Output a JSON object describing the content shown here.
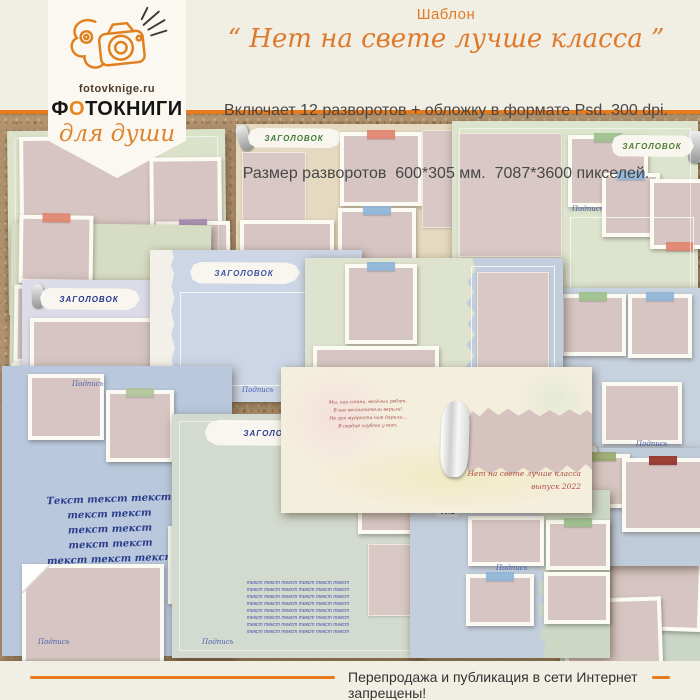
{
  "header": {
    "title": "Шаблон",
    "quote": "“ Нет на свете лучше класса ”",
    "desc1": "Включает 12 разворотов + обложку в формате Psd. 300 dpi.",
    "desc2": "Размер разворотов  600*305 мм.  7087*3600 пикселей."
  },
  "logo": {
    "site": "fotovknige.ru",
    "brand_parts": [
      "Ф",
      "О",
      "ТОКНИГИ"
    ],
    "tagline": "для души"
  },
  "footer": {
    "notice": "Перепродажа и публикация в сети Интернет запрещены!"
  },
  "colors": {
    "accent_orange": "#e87a1e",
    "cork": "#b2946f",
    "photo_placeholder": "#d6c5c2"
  },
  "collage": {
    "spreads": [
      {
        "name": "top-left",
        "x": 8,
        "y": 17,
        "w": 218,
        "h": 184,
        "rot": -0.6,
        "bg": "#dbe2ca",
        "inner": true,
        "el": [
          {
            "t": "photo",
            "x": 12,
            "y": 6,
            "w": 128,
            "h": 104
          },
          {
            "t": "photo",
            "x": 142,
            "y": 28,
            "w": 64,
            "h": 88
          },
          {
            "t": "photo",
            "x": 4,
            "y": 116,
            "w": 80,
            "h": 66,
            "tape": "#dd8873"
          },
          {
            "t": "photo",
            "x": 90,
            "y": 118,
            "w": 82,
            "h": 68,
            "tape": "#a98bb4"
          },
          {
            "t": "photo",
            "x": 148,
            "y": 92,
            "w": 66,
            "h": 86,
            "tape": "#a98bb4"
          }
        ]
      },
      {
        "name": "top-center",
        "x": 236,
        "y": 11,
        "w": 238,
        "h": 172,
        "rot": 0,
        "bg": "#e5dabf",
        "el": [
          {
            "t": "banner",
            "x": 10,
            "y": 4,
            "w": 96,
            "h": 20,
            "text": "ЗАГОЛОВОК",
            "color": "#3e7a35",
            "deco": "clip"
          },
          {
            "t": "panel",
            "x": 6,
            "y": 28,
            "w": 62,
            "h": 74
          },
          {
            "t": "photo",
            "x": 104,
            "y": 8,
            "w": 74,
            "h": 66,
            "tape": "#e0846e"
          },
          {
            "t": "photo",
            "x": 102,
            "y": 84,
            "w": 70,
            "h": 66,
            "tape": "#8fb4d8"
          },
          {
            "t": "photo",
            "x": 4,
            "y": 96,
            "w": 86,
            "h": 64
          },
          {
            "t": "panel",
            "x": 186,
            "y": 6,
            "w": 50,
            "h": 96
          }
        ]
      },
      {
        "name": "top-right",
        "x": 452,
        "y": 8,
        "w": 246,
        "h": 178,
        "rot": 0,
        "bg": "#dde4cd",
        "inner": true,
        "el": [
          {
            "t": "panel",
            "x": 6,
            "y": 12,
            "w": 102,
            "h": 122
          },
          {
            "t": "photo",
            "x": 116,
            "y": 14,
            "w": 72,
            "h": 64,
            "tape": "#9dc08d"
          },
          {
            "t": "caption",
            "x": 120,
            "y": 84,
            "text": "Подпись"
          },
          {
            "t": "banner",
            "x": 158,
            "y": 14,
            "w": 84,
            "h": 22,
            "text": "ЗАГОЛОВОК",
            "color": "#4e7d2e",
            "deco": "roll"
          },
          {
            "t": "photo",
            "x": 150,
            "y": 52,
            "w": 50,
            "h": 56,
            "tape": "#8fb4d8"
          },
          {
            "t": "photo",
            "x": 198,
            "y": 58,
            "w": 52,
            "h": 62,
            "tape": "#e0846e",
            "tapePos": "bottom"
          },
          {
            "t": "frame",
            "x": 118,
            "y": 96,
            "w": 122,
            "h": 74
          }
        ]
      },
      {
        "name": "left-2",
        "x": 10,
        "y": 111,
        "w": 200,
        "h": 200,
        "rot": 0.8,
        "bg": "#d6ddc3",
        "el": [
          {
            "t": "photo",
            "x": 8,
            "y": -8,
            "w": 66,
            "h": 60,
            "tape": "#e0846e"
          },
          {
            "t": "photo",
            "x": 4,
            "y": 62,
            "w": 86,
            "h": 70,
            "tape": "#8fb4d8"
          },
          {
            "t": "photo",
            "x": 2,
            "y": 140,
            "w": 74,
            "h": 66
          },
          {
            "t": "photo",
            "x": 96,
            "y": 70,
            "w": 72,
            "h": 92
          }
        ]
      },
      {
        "name": "right-cream",
        "x": 584,
        "y": 179,
        "w": 116,
        "h": 172,
        "rot": 0,
        "bg": "#e7e4d2",
        "el": [
          {
            "t": "panel",
            "x": 6,
            "y": 6,
            "w": 102,
            "h": 48
          },
          {
            "t": "rows",
            "x": 6,
            "y": 64,
            "w": 102,
            "line": "Текст текст текст текст",
            "count": 4,
            "size": 5,
            "color": "#5a7a46"
          },
          {
            "t": "photo",
            "x": 8,
            "y": 118,
            "w": 98,
            "h": 46
          }
        ]
      },
      {
        "name": "right-blue",
        "x": 552,
        "y": 175,
        "w": 148,
        "h": 176,
        "rot": 0,
        "bg": "#c7d2df",
        "el": [
          {
            "t": "photo",
            "x": 8,
            "y": 6,
            "w": 58,
            "h": 54,
            "tape": "#9dc08d"
          },
          {
            "t": "photo",
            "x": 76,
            "y": 6,
            "w": 56,
            "h": 56,
            "tape": "#8fb4d8"
          },
          {
            "t": "photo",
            "x": 50,
            "y": 94,
            "w": 72,
            "h": 54
          },
          {
            "t": "caption",
            "x": 84,
            "y": 152,
            "text": "Подпись"
          }
        ]
      },
      {
        "name": "mid-lavender",
        "x": 22,
        "y": 167,
        "w": 152,
        "h": 212,
        "rot": 0,
        "bg": "#dcdce8",
        "el": [
          {
            "t": "banner",
            "x": 16,
            "y": 8,
            "w": 102,
            "h": 22,
            "text": "ЗАГОЛОВОК",
            "color": "#23368f",
            "deco": "pin"
          },
          {
            "t": "photo",
            "x": 8,
            "y": 38,
            "w": 120,
            "h": 88
          },
          {
            "t": "photo",
            "x": 4,
            "y": 136,
            "w": 58,
            "h": 64,
            "tape": "#c9a06c"
          },
          {
            "t": "photo",
            "x": 66,
            "y": 138,
            "w": 64,
            "h": 66,
            "tape": "#8fb4d8"
          }
        ]
      },
      {
        "name": "mid-blue",
        "x": 150,
        "y": 137,
        "w": 212,
        "h": 152,
        "rot": 0,
        "bg": "#ccd6e6",
        "el": [
          {
            "t": "torn",
            "x": 0,
            "y": 0,
            "w": 26,
            "h": 152,
            "color": "#f2f0e8",
            "v": true
          },
          {
            "t": "banner",
            "x": 38,
            "y": 12,
            "w": 112,
            "h": 22,
            "text": "ЗАГОЛОВОК",
            "color": "#3c55a4"
          },
          {
            "t": "frame",
            "x": 30,
            "y": 42,
            "w": 150,
            "h": 92
          },
          {
            "t": "caption",
            "x": 92,
            "y": 136,
            "text": "Подпись"
          }
        ]
      },
      {
        "name": "mid-green",
        "x": 305,
        "y": 145,
        "w": 258,
        "h": 150,
        "rot": 0,
        "bg": "#dde3cf",
        "bg2": {
          "color": "#c2cede",
          "from": 0.6
        },
        "el": [
          {
            "t": "photo",
            "x": 40,
            "y": 6,
            "w": 64,
            "h": 72,
            "tape": "#8fb4d8"
          },
          {
            "t": "photo",
            "x": 8,
            "y": 88,
            "w": 118,
            "h": 56
          },
          {
            "t": "frame",
            "x": 166,
            "y": 8,
            "w": 82,
            "h": 128
          },
          {
            "t": "panel",
            "x": 172,
            "y": 14,
            "w": 70,
            "h": 116
          },
          {
            "t": "caption",
            "x": 196,
            "y": 138,
            "text": "Подпись"
          }
        ]
      },
      {
        "name": "bottom-left",
        "x": 2,
        "y": 253,
        "w": 230,
        "h": 290,
        "rot": 0,
        "bg": "#b9c8dc",
        "el": [
          {
            "t": "photo",
            "x": 26,
            "y": 8,
            "w": 68,
            "h": 58
          },
          {
            "t": "caption",
            "x": 70,
            "y": 14,
            "text": "Подпись"
          },
          {
            "t": "photo",
            "x": 104,
            "y": 24,
            "w": 60,
            "h": 64,
            "tape": "#b0c49a"
          },
          {
            "t": "photo",
            "x": 186,
            "y": 76,
            "w": 46,
            "h": 66,
            "tape": "#8fb4d8"
          },
          {
            "t": "script",
            "x": 18,
            "y": 126,
            "w": 180,
            "lines": [
              "Текст текст текст",
              "текст текст",
              "текст текст",
              "текст текст",
              "текст текст текст"
            ],
            "size": 10,
            "lh": 15,
            "color": "#2b3c8c",
            "bold": true,
            "italic": true,
            "rot": -2,
            "align": "center"
          },
          {
            "t": "photo",
            "x": 166,
            "y": 160,
            "w": 60,
            "h": 70,
            "tape": "#9dc08d"
          },
          {
            "t": "photo",
            "x": 20,
            "y": 198,
            "w": 134,
            "h": 100,
            "fold": true
          },
          {
            "t": "caption",
            "x": 36,
            "y": 272,
            "text": "Подпись"
          }
        ]
      },
      {
        "name": "bottom-center",
        "x": 172,
        "y": 301,
        "w": 250,
        "h": 244,
        "rot": 0,
        "bg": "#d3dacf",
        "inner": true,
        "el": [
          {
            "t": "banner",
            "x": 30,
            "y": 6,
            "w": 142,
            "h": 26,
            "text": "ЗАГОЛОВОК",
            "color": "#2c3f96"
          },
          {
            "t": "photo",
            "x": 186,
            "y": 40,
            "w": 80,
            "h": 72
          },
          {
            "t": "panel",
            "x": 196,
            "y": 130,
            "w": 60,
            "h": 70
          },
          {
            "t": "rows",
            "x": 28,
            "y": 166,
            "w": 196,
            "line": "текст  текст  текст  текст  текст  текст",
            "count": 8,
            "size": 5,
            "color": "#4a55b0",
            "italic": true
          },
          {
            "t": "caption",
            "x": 30,
            "y": 224,
            "text": "Подпись"
          }
        ]
      },
      {
        "name": "bottom-right",
        "x": 560,
        "y": 357,
        "w": 140,
        "h": 212,
        "rot": 0,
        "bg": "#c9d6c8",
        "el": [
          {
            "t": "photo",
            "x": 14,
            "y": 14,
            "w": 112,
            "h": 60,
            "rot": -3,
            "pin": true
          },
          {
            "t": "photo",
            "x": 24,
            "y": 86,
            "w": 110,
            "h": 66,
            "rot": 2,
            "pin": true
          },
          {
            "t": "photo",
            "x": 4,
            "y": 128,
            "w": 90,
            "h": 62,
            "rot": -2
          },
          {
            "t": "caption",
            "x": 58,
            "y": 196,
            "text": "Подпись"
          }
        ]
      },
      {
        "name": "right-lower",
        "x": 444,
        "y": 335,
        "w": 256,
        "h": 118,
        "rot": 0,
        "bg": "#bfccd9",
        "el": [
          {
            "t": "curl",
            "x": 108,
            "y": -4,
            "w": 46,
            "h": 28,
            "rot": -8
          },
          {
            "t": "photo",
            "x": 130,
            "y": 6,
            "w": 48,
            "h": 46,
            "tape": "#9aa86f"
          },
          {
            "t": "photo",
            "x": 178,
            "y": 10,
            "w": 74,
            "h": 66,
            "tape": "#963128"
          }
        ]
      },
      {
        "name": "bottom-split",
        "x": 410,
        "y": 377,
        "w": 200,
        "h": 168,
        "rot": 0,
        "bg": "#c3cfdd",
        "bg2": {
          "color": "#ccd8c4",
          "from": 0.62
        },
        "el": [
          {
            "t": "label",
            "x": 26,
            "y": 18,
            "text": "ФИО",
            "color": "#1f2d7a"
          },
          {
            "t": "photo",
            "x": 58,
            "y": 26,
            "w": 68,
            "h": 42
          },
          {
            "t": "caption",
            "x": 86,
            "y": 74,
            "text": "Подпись"
          },
          {
            "t": "photo",
            "x": 56,
            "y": 84,
            "w": 60,
            "h": 44,
            "tape": "#8fb4d8"
          },
          {
            "t": "photo",
            "x": 136,
            "y": 30,
            "w": 56,
            "h": 42,
            "tape": "#9dc08d"
          },
          {
            "t": "photo",
            "x": 134,
            "y": 82,
            "w": 58,
            "h": 44
          }
        ]
      },
      {
        "name": "cover",
        "x": 281,
        "y": 254,
        "w": 311,
        "h": 146,
        "rot": 0,
        "bg": "#f4eedd",
        "cover": true,
        "el": [
          {
            "t": "script",
            "x": 22,
            "y": 32,
            "w": 130,
            "lines": [
              "Мы, как сотни, весёлых ребят,",
              "В нас воспитатели верили!",
              "Не зря мудрости нам дарили...",
              "В сердце глубоко у всех."
            ],
            "size": 4.6,
            "lh": 8,
            "color": "#a34b45",
            "italic": true,
            "rot": -1,
            "align": "center"
          },
          {
            "t": "torn",
            "x": 186,
            "y": 38,
            "w": 125,
            "h": 72,
            "color": "#d6c3c0"
          },
          {
            "t": "curl",
            "x": 160,
            "y": 34,
            "w": 28,
            "h": 76,
            "rot": 2
          },
          {
            "t": "script",
            "x": 168,
            "y": 100,
            "w": 132,
            "lines": [
              "Нет на свете лучше класса",
              "выпуск 2022"
            ],
            "size": 7.5,
            "lh": 13,
            "color": "#ad4d45",
            "italic": true,
            "align": "right"
          }
        ]
      }
    ]
  }
}
